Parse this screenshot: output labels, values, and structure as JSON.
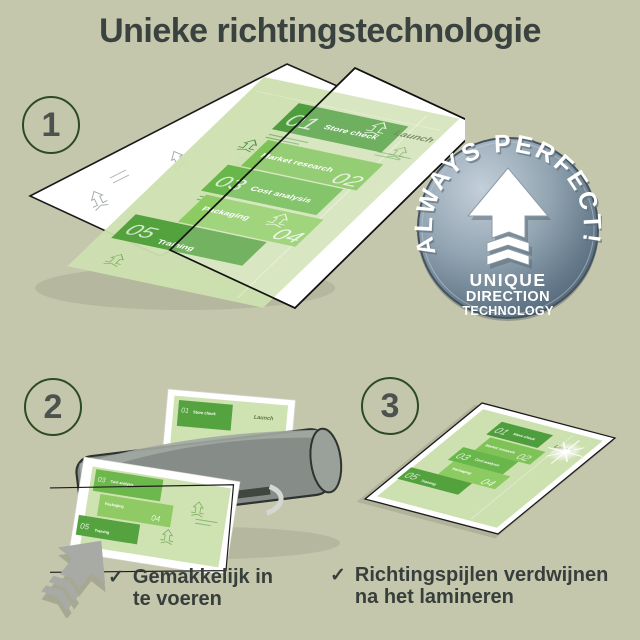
{
  "title": "Unieke richtingstechnologie",
  "steps": [
    {
      "number": "1"
    },
    {
      "number": "2"
    },
    {
      "number": "3"
    }
  ],
  "badge": {
    "arc_text": "ALWAYS PERFECT!",
    "line1": "UNIQUE",
    "line2": "DIRECTION",
    "line3": "TECHNOLOGY",
    "icon": "up-arrow-with-chevrons-icon"
  },
  "plan_document": {
    "launch_label": "Launch",
    "items": [
      {
        "num": "01",
        "label": "Store check"
      },
      {
        "num": "02",
        "label": "Market research"
      },
      {
        "num": "03",
        "label": "Cost analysis"
      },
      {
        "num": "04",
        "label": "Packaging"
      },
      {
        "num": "05",
        "label": "Training"
      }
    ]
  },
  "checklist": [
    {
      "line1": "Gemakkelijk in",
      "line2": "te voeren"
    },
    {
      "line1": "Richtingspijlen verdwijnen",
      "line2": "na het lamineren"
    }
  ],
  "icons": {
    "check": "✓"
  },
  "colors": {
    "background": "#c5c7ac",
    "title_text": "#3a4240",
    "circle_ring": "#2c4a24",
    "green_dark": "#4f9e3d",
    "green_mid": "#7ec356",
    "green_light": "#8ccb61",
    "page_green": "#cde0b0",
    "badge_metal": "#64798a",
    "laminator_gray": "#868c87",
    "arrow_gray": "#a8aaa5"
  }
}
